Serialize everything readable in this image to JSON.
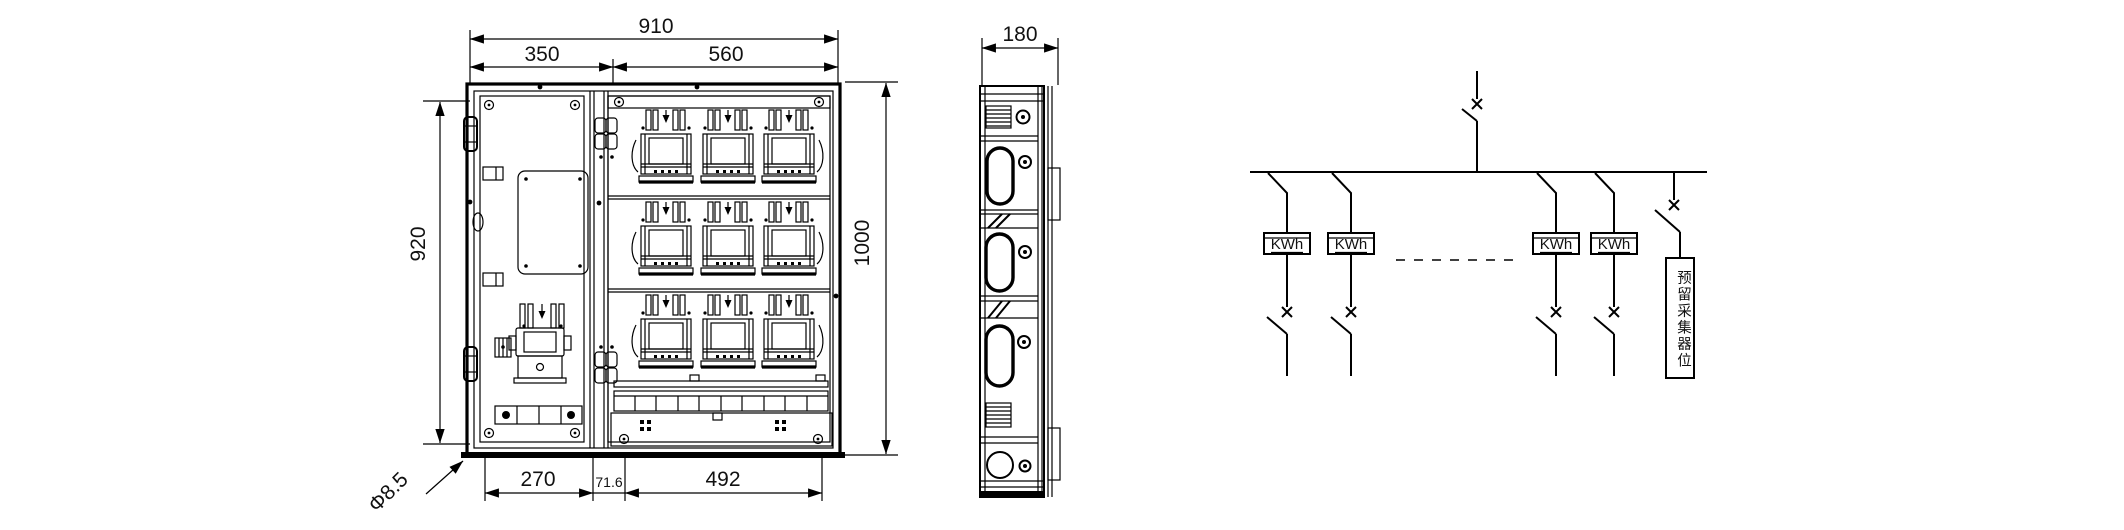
{
  "front_view": {
    "dims": {
      "total_width": "910",
      "left_width": "350",
      "right_width": "560",
      "door_height": "920",
      "total_height": "1000",
      "bottom_left": "270",
      "bottom_mid": "71.6",
      "bottom_right": "492",
      "mount_hole": "Φ8.5"
    },
    "meter_rows": 3,
    "meter_cols": 3
  },
  "side_view": {
    "dims": {
      "depth": "180"
    }
  },
  "schematic": {
    "meter_label": "KWh",
    "reserved_label": "预留采集器位"
  },
  "colors": {
    "line": "#000000",
    "background": "#ffffff"
  }
}
